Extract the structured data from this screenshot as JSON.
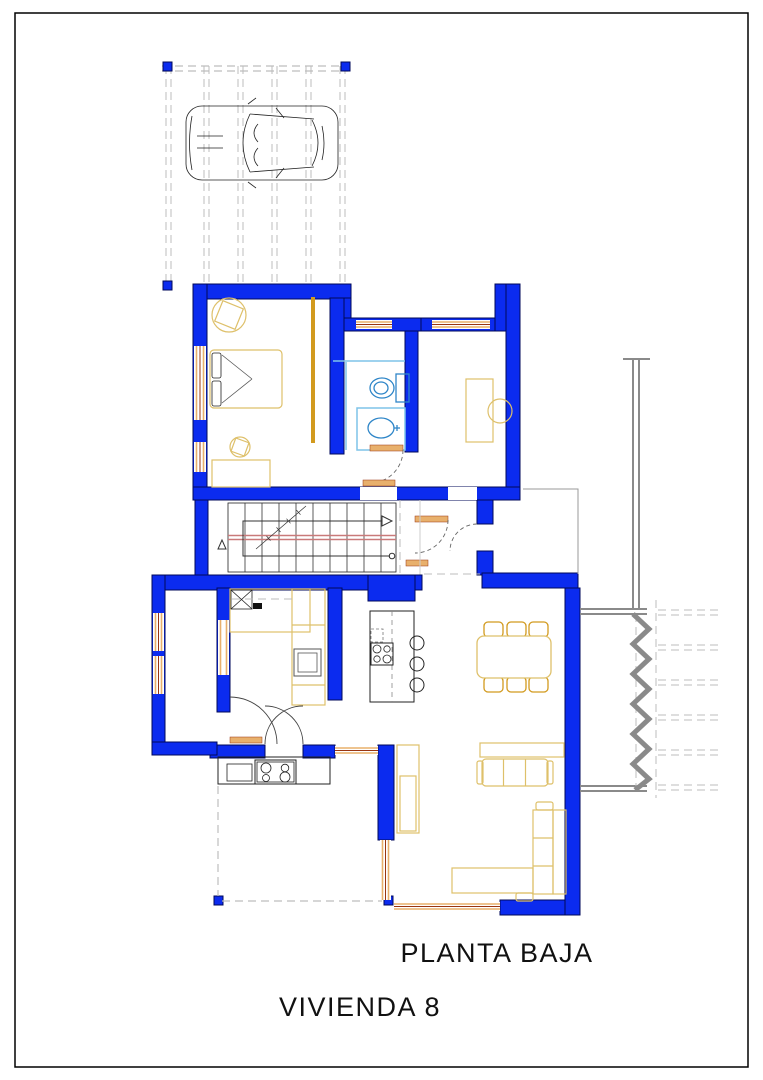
{
  "document": {
    "kind": "architectural-floor-plan",
    "labels": {
      "plan_title": "PLANTA BAJA",
      "dwelling_title": "VIVIENDA 8"
    },
    "colors": {
      "paper": "#ffffff",
      "wall_fill": "#0b2bef",
      "wall_outline": "#00085a",
      "furniture_tan": "#dec06a",
      "furniture_gold": "#d29a1e",
      "window_sill": "#e8b06c",
      "window_frame": "#993511",
      "bath_fixture": "#2f86c8",
      "shower_glass": "#7fc4e8",
      "stair_handrail": "#c97a7a",
      "site_gray": "#8a8a8a",
      "dash_gray": "#bdbdbd",
      "line_black": "#222222"
    }
  }
}
